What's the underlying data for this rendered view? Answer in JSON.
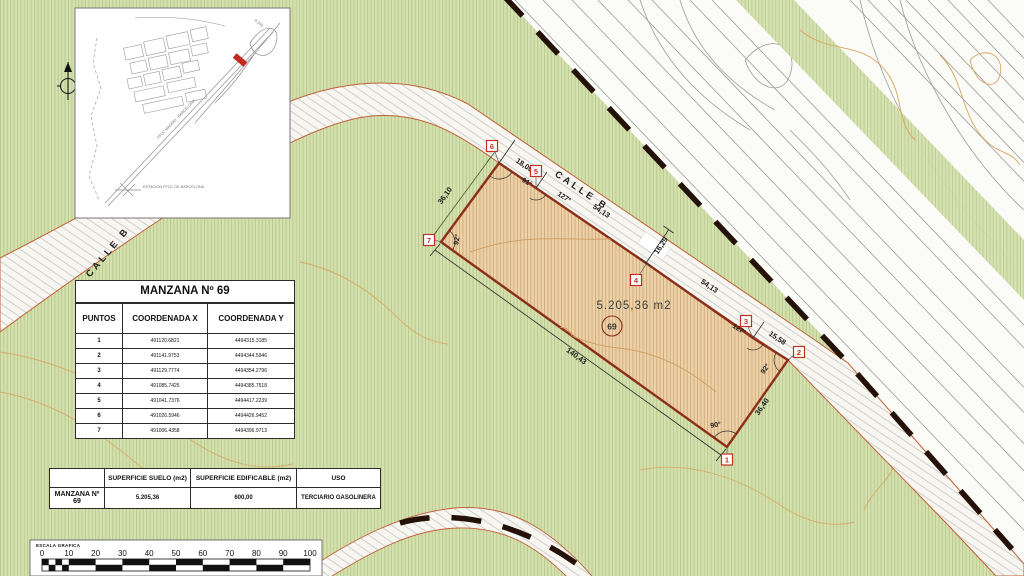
{
  "inset_map": {
    "labels": {
      "road": "N 340",
      "railway": "FFCC MADRID - BARCELONA",
      "station": "ESTACION FFCC DE BARCELONA"
    }
  },
  "tables": {
    "coordinates": {
      "title": "MANZANA Nº 69",
      "headers": [
        "PUNTOS",
        "COORDENADA X",
        "COORDENADA Y"
      ],
      "rows": [
        {
          "punto": "1",
          "x": "491120.6821",
          "y": "4494315.3185"
        },
        {
          "punto": "2",
          "x": "491141.9753",
          "y": "4494344.5946"
        },
        {
          "punto": "3",
          "x": "491129.7774",
          "y": "4494354.2796"
        },
        {
          "punto": "4",
          "x": "491085.7425",
          "y": "4494385.7518"
        },
        {
          "punto": "5",
          "x": "491041.7376",
          "y": "4494417.2239"
        },
        {
          "punto": "6",
          "x": "491026.5946",
          "y": "4494426.9452"
        },
        {
          "punto": "7",
          "x": "491006.4358",
          "y": "4494396.9713"
        }
      ]
    },
    "surface": {
      "headers": [
        "",
        "SUPERFICIE SUELO (m2)",
        "SUPERFICIE EDIFICABLE (m2)",
        "USO"
      ],
      "row": {
        "label": "MANZANA Nº 69",
        "suelo": "5.205,36",
        "edificable": "600,00",
        "uso": "TERCIARIO GASOLINERA"
      }
    }
  },
  "scale_bar": {
    "label": "ESCALA GRAFICA",
    "ticks": [
      "0",
      "10",
      "20",
      "30",
      "40",
      "50",
      "60",
      "70",
      "80",
      "90",
      "100"
    ]
  },
  "plot": {
    "area_label": "5.205,36 m2",
    "parcel_number": "69",
    "street_label_top": "CALLE B",
    "street_label_left": "CALLE B",
    "points": [
      "1",
      "2",
      "3",
      "4",
      "5",
      "6",
      "7"
    ],
    "dimensions": {
      "d18": "18,00",
      "d5413a": "54,13",
      "d1629": "16,29",
      "d5413b": "54,13",
      "d1558": "15,58",
      "d3640": "36,40",
      "d14043": "140,43",
      "d3610": "36,10"
    },
    "angles": {
      "a6": "91°",
      "a5": "127°",
      "a3": "127°",
      "a2": "92°",
      "a1": "90°",
      "a7": "92°"
    }
  },
  "colors": {
    "background_green": "#d4e0b0",
    "parcel_fill": "#ecd2a8",
    "parcel_border": "#8c2f1b",
    "road_edge": "#c06038",
    "contour": "#d8a55f",
    "boundary_dash": "#241208",
    "point_marker_red": "#c23126"
  }
}
